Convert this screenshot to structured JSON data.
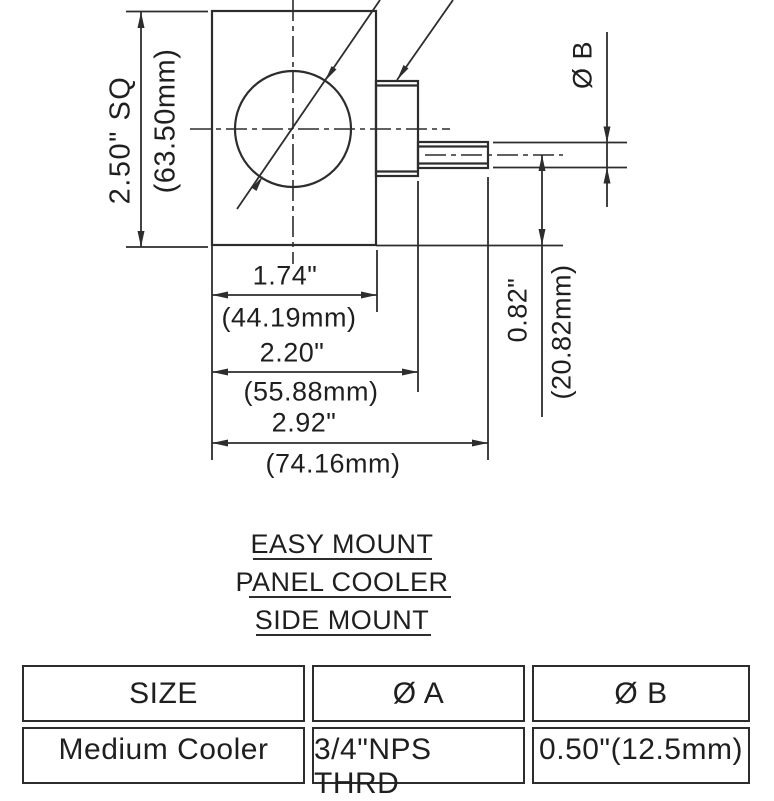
{
  "drawing": {
    "title_lines": [
      "EASY MOUNT",
      "PANEL COOLER",
      "SIDE MOUNT"
    ],
    "labels": {
      "plate_in": "2.50\" SQ",
      "plate_mm": "(63.50mm)",
      "width1_in": "1.74\"",
      "width1_mm": "(44.19mm)",
      "width2_in": "2.20\"",
      "width2_mm": "(55.88mm)",
      "width3_in": "2.92\"",
      "width3_mm": "(74.16mm)",
      "offset_in": "0.82\"",
      "offset_mm": "(20.82mm)",
      "dia_b": "Ø B"
    }
  },
  "table": {
    "headers": [
      "SIZE",
      "Ø A",
      "Ø B"
    ],
    "rows": [
      [
        "Medium Cooler",
        "3/4\"NPS THRD",
        "0.50\"(12.5mm)"
      ]
    ]
  },
  "colors": {
    "line": "#2d2d2d",
    "text": "#1f1f1f",
    "background": "#ffffff"
  }
}
